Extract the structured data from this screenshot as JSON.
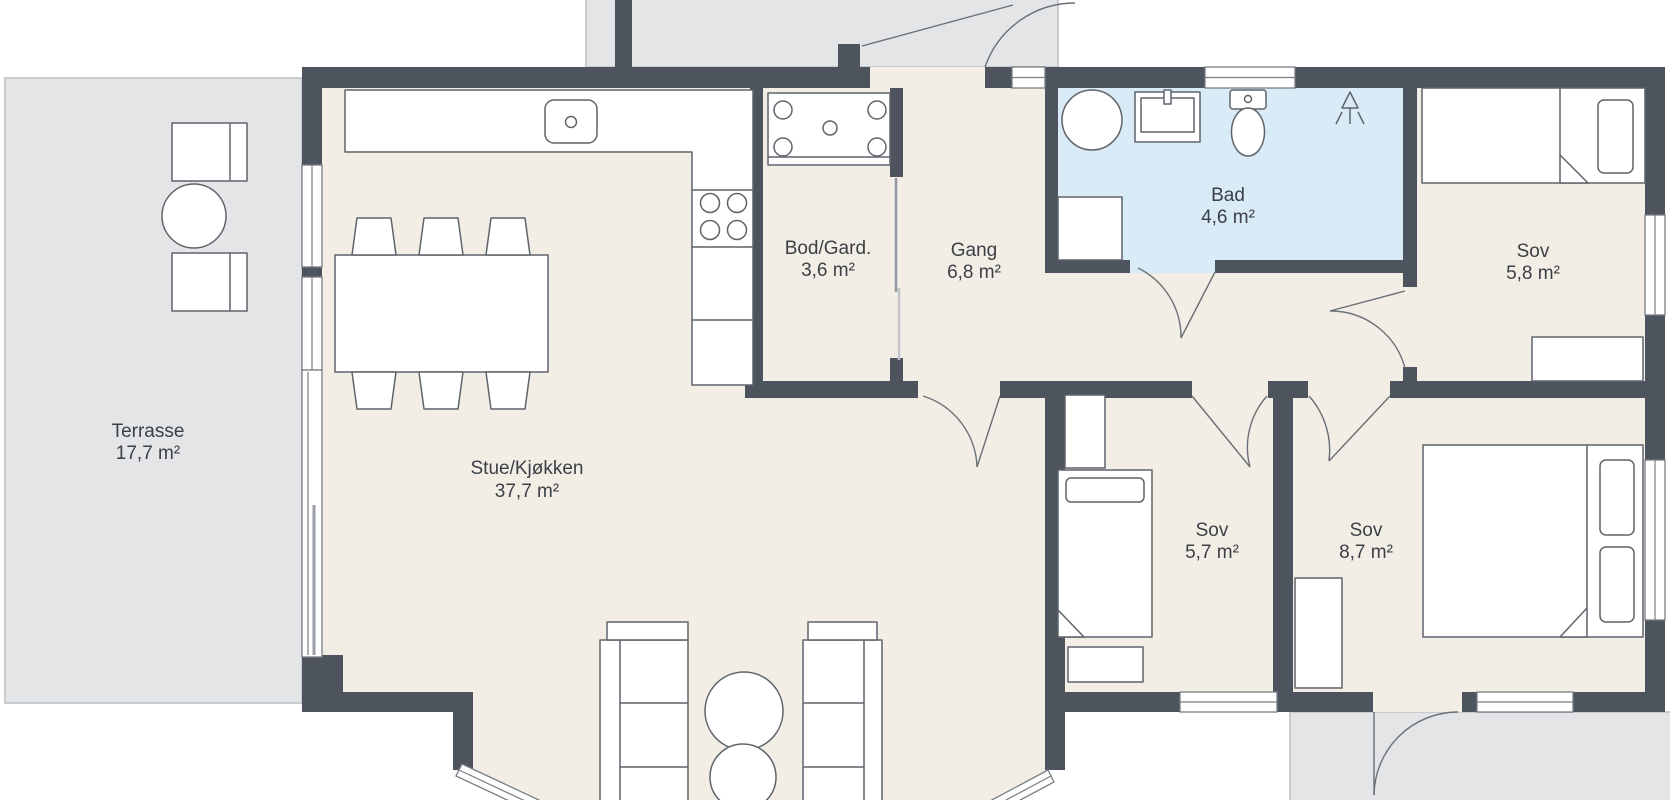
{
  "plan_title": "Floor plan",
  "rooms": [
    {
      "name": "Terrasse",
      "area": "17,7 m²"
    },
    {
      "name": "Stue/Kjøkken",
      "area": "37,7 m²"
    },
    {
      "name": "Bod/Gard.",
      "area": "3,6 m²"
    },
    {
      "name": "Gang",
      "area": "6,8 m²"
    },
    {
      "name": "Bad",
      "area": "4,6 m²"
    },
    {
      "name": "Sov",
      "area": "5,8 m²"
    },
    {
      "name": "Sov",
      "area": "5,7 m²"
    },
    {
      "name": "Sov",
      "area": "8,7 m²"
    }
  ],
  "colors": {
    "wall": "#4d545e",
    "floor": "#f2eee5",
    "bathroom_floor": "#d9ebf7",
    "outdoor": "#e4e5e7",
    "outdoor_border": "#c9ccce",
    "furniture_outline": "#5f646b",
    "label_text": "#3b4046",
    "background": "#ffffff"
  }
}
